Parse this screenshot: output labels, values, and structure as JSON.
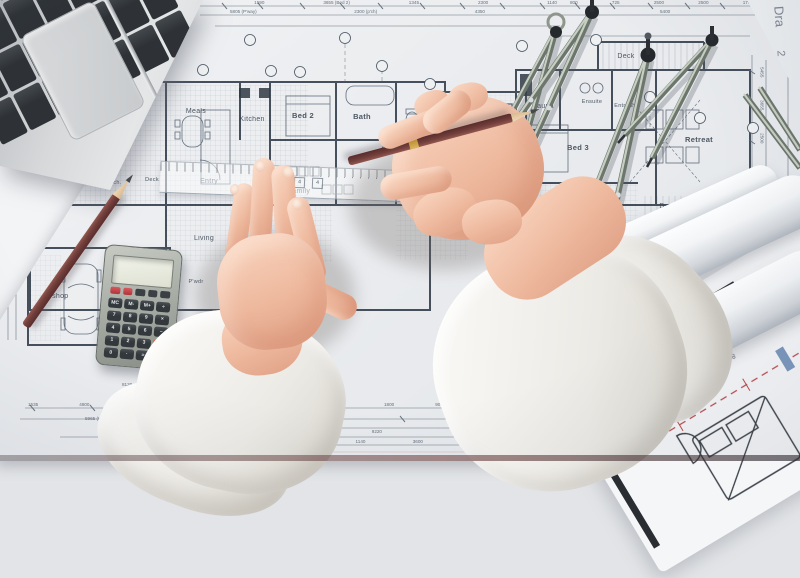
{
  "plan": {
    "rooms": {
      "meals": "Meals",
      "kitchen": "Kitchen",
      "bed2": "Bed 2",
      "bath": "Bath",
      "spa": "Spa",
      "deck_spa": "Deck",
      "sauna": "Sauna",
      "ensuite": "Ensuite",
      "entry2": "Entry 2",
      "deck_top": "Deck",
      "bed3": "Bed 3",
      "retreat": "Retreat",
      "patio": "Patio",
      "deck_right": "Deck",
      "entry": "Entry",
      "living": "Living",
      "family": "Family",
      "porte": "Porte coch.",
      "deck_left": "Deck",
      "wshop": "W'shop",
      "pwdr": "P'wdr"
    },
    "title_vertical": "Dra",
    "sheet_number": "2",
    "roll_text": "8.7T X 8' OC EXO",
    "ruler_marks": [
      "4",
      "4",
      "4"
    ],
    "dims": {
      "t1": [
        "5800",
        "1590",
        "3655 (Bed 2)",
        "1345",
        "2300",
        "1140"
      ],
      "t2": [
        "800",
        "725",
        "2500",
        "2500",
        "1740"
      ],
      "t3": [
        "5805 (P'way)",
        "2300 (p'ch)",
        "4350"
      ],
      "t4": "5400",
      "right": [
        "5455",
        "3655",
        "2500",
        "1090",
        "2440"
      ],
      "b1": [
        "1535",
        "4800",
        "2000",
        "1800",
        "2090",
        "1140",
        "900",
        "1800",
        "900"
      ],
      "b1b": [
        "1200",
        "1010"
      ],
      "wshop_garage": "5965 (W'shop / Garage)",
      "b2": [
        "1500",
        "9220"
      ],
      "b3": [
        "1600",
        "1140",
        "3600"
      ],
      "bed3_dim": "4400 (Bed 3)",
      "b5": [
        "1200",
        "1800",
        "4200"
      ],
      "b6": [
        "2600",
        "1000",
        "2040"
      ],
      "b7": "12000",
      "b8": "8120"
    }
  },
  "calculator": {
    "display_value": "",
    "top_keys": [
      "",
      "",
      "",
      "",
      ""
    ],
    "keys": [
      [
        "MC",
        "M-",
        "M+",
        "÷"
      ],
      [
        "7",
        "8",
        "9",
        "×"
      ],
      [
        "4",
        "5",
        "6",
        "−"
      ],
      [
        "1",
        "2",
        "3",
        "+"
      ],
      [
        "0",
        "·",
        "="
      ]
    ]
  },
  "colors": {
    "paper": "#edeff1",
    "line": "#3c4652",
    "skin": "#efbfa4",
    "pencil_body": "#6e3938",
    "sleeve_white": "#f5f4f1",
    "calc_key_dark": "#3b4044",
    "calc_key_red": "#c0393f",
    "calc_key_orange": "#c4543c",
    "metal_arm": "#8f988d",
    "centerline_red": "#b84b4b"
  }
}
